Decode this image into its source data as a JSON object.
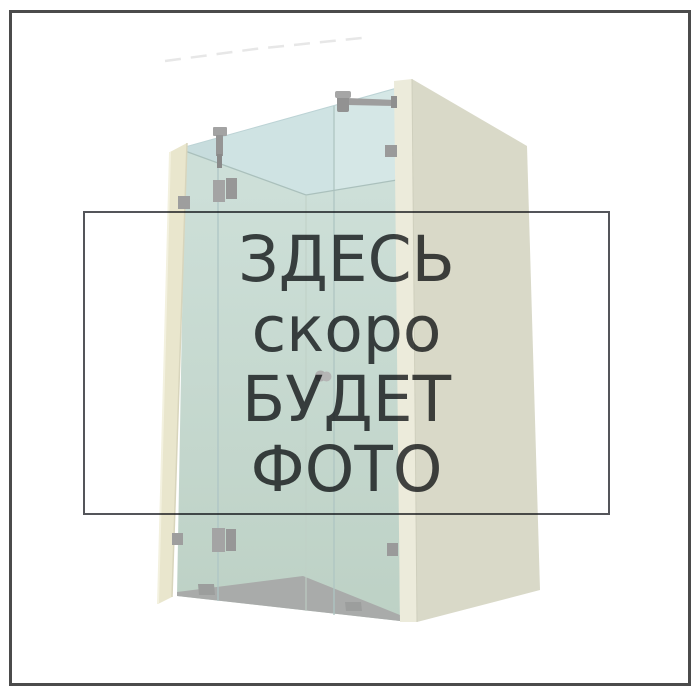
{
  "image": {
    "kind": "product-photo-placeholder",
    "width": 700,
    "height": 700,
    "background": "#ffffff",
    "frame_border_color": "#4b4b4b"
  },
  "placeholder": {
    "lines": [
      "ЗДЕСЬ",
      "скоро",
      "БУДЕТ",
      "ФОТО"
    ],
    "text_color": "#45474a",
    "box_border_color": "#54555a"
  },
  "illustration": {
    "name": "glass-shower-enclosure-render",
    "colors": {
      "glass_upper": "#cfe3e3",
      "glass_upper_left": "#c7dcdd",
      "glass_upper_right": "#d5e7e6",
      "glass_lower_top": "#cddfd8",
      "glass_lower_bottom": "#bdd1c5",
      "wall_front": "#ecebdb",
      "wall_side": "#d9d9c8",
      "pillar": "#e9e6cd",
      "floor": "#a9abaa",
      "metal": "#9b9b9b",
      "knob": "#b5b5b5"
    }
  }
}
